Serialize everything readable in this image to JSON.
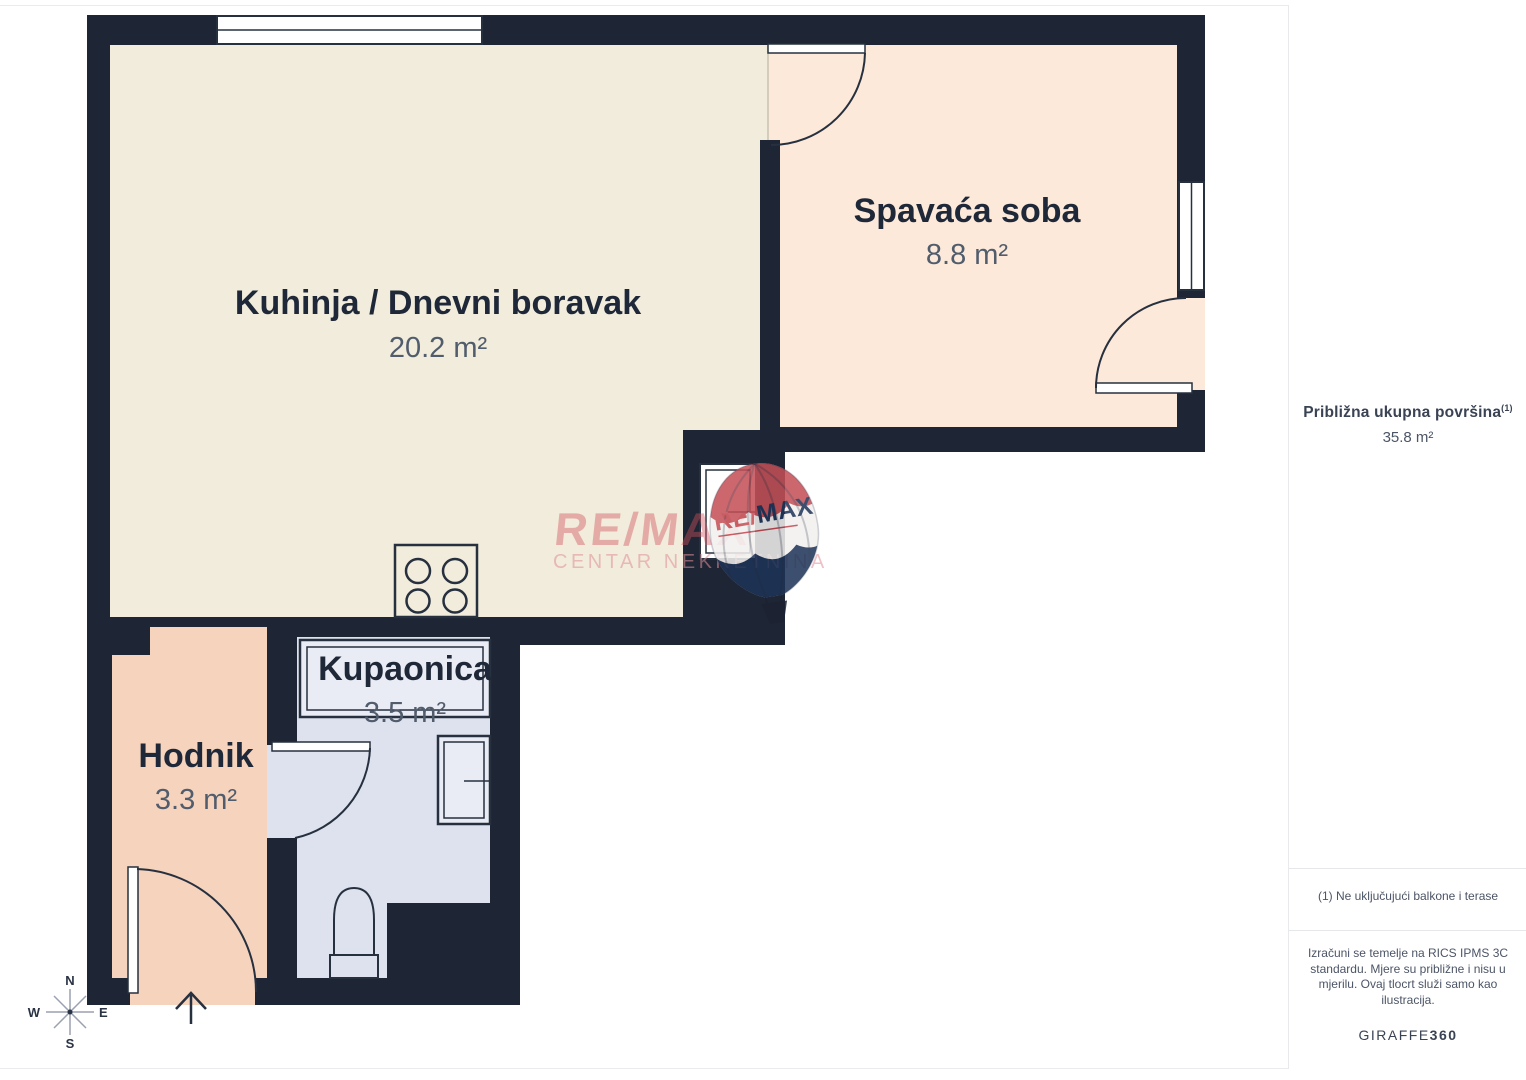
{
  "floorplan": {
    "rooms": [
      {
        "id": "kitchen-living",
        "name": "Kuhinja / Dnevni boravak",
        "area": "20.2 m²"
      },
      {
        "id": "bedroom",
        "name": "Spavaća soba",
        "area": "8.8 m²"
      },
      {
        "id": "bathroom",
        "name": "Kupaonica",
        "area": "3.5 m²"
      },
      {
        "id": "hallway",
        "name": "Hodnik",
        "area": "3.3 m²"
      }
    ],
    "colors": {
      "wall": "#1e2534",
      "kitchen_fill": "#f1ecdb",
      "bedroom_fill": "#fce9d9",
      "bathroom_fill": "#dde2ee",
      "hallway_fill": "#f5d3bc",
      "fixture_stroke": "#27303f"
    },
    "compass": {
      "north": "N",
      "south": "S",
      "east": "E",
      "west": "W"
    }
  },
  "watermark": {
    "brand": "RE/MAX",
    "subtitle": "CENTAR NEKRETNINA",
    "balloon_text_left": "RE/",
    "balloon_text_right": "MAX",
    "colors": {
      "text_red": "#d4545e",
      "text_pink": "#df8f98",
      "balloon_red": "#c44f56",
      "balloon_navy": "#1d3357"
    }
  },
  "sidebar": {
    "total_label": "Približna ukupna površina",
    "total_superscript": "(1)",
    "total_value": "35.8 m²",
    "footnote": "(1) Ne uključujući balkone i terase",
    "disclaimer": "Izračuni se temelje na RICS IPMS 3C standardu. Mjere su približne i nisu u mjerilu. Ovaj tlocrt služi samo kao ilustracija.",
    "brand_name": "GIRAFFE",
    "brand_suffix": "360"
  }
}
